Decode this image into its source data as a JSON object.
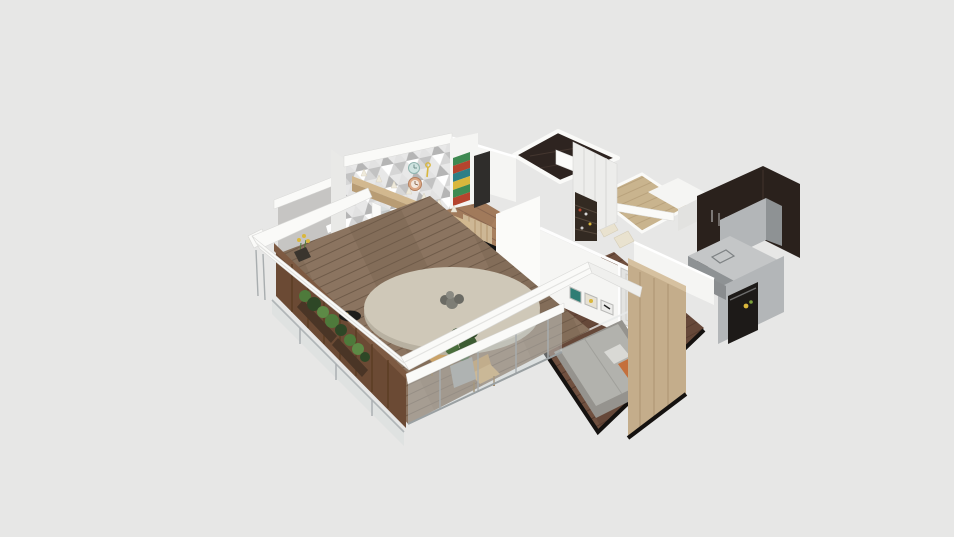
{
  "scene": {
    "type": "3d-floorplan-isometric-render",
    "description": "White-walled apartment model viewed from above at an angle on a plain light-gray backdrop; no UI chrome, text or controls visible",
    "background_color": "#e7e7e6",
    "rooms": [
      {
        "name": "balcony-terrace",
        "floor": "wood-deck",
        "features": [
          "wood-privacy-fence",
          "hedge-planters",
          "glass-railings",
          "round-dining-table",
          "dark-centerpiece",
          "two-wooden-chairs",
          "potted-plant",
          "yellow-flower-pot",
          "white-pergola-beams"
        ]
      },
      {
        "name": "living-room",
        "floor": "wood",
        "features": [
          "triangle-mosaic-accent-wall",
          "teal-wall-clock",
          "copper-wall-clock",
          "key-wall-decor",
          "striped-artwork",
          "bar-ledge-with-cone-lamps",
          "glass-partition",
          "white-staircase",
          "black-stools",
          "tv-screen",
          "gold-mosaic-panels",
          "wood-slat-panel",
          "gray-concrete-wall",
          "terrazzo-strip",
          "white-shelves"
        ]
      },
      {
        "name": "bedroom",
        "floor": "dark-wood",
        "features": [
          "gray-bed",
          "orange-pillow",
          "white-pillow",
          "oak-wardrobe-panel",
          "three-art-frames",
          "white-door",
          "glass-partition",
          "black-base-trim"
        ]
      },
      {
        "name": "walk-in-closet",
        "floor": "dark-gloss-tile",
        "features": [
          "white-wardrobe-fronts",
          "open-shoe-shelf",
          "white-cabinet"
        ]
      },
      {
        "name": "hallway-dining",
        "floor": "light-oak",
        "features": [
          "cream-chairs",
          "white-wall-beams"
        ]
      },
      {
        "name": "kitchen",
        "walls": "dark-brown",
        "features": [
          "gray-cabinets",
          "counter-with-sink",
          "black-oven-front",
          "hanging-utensils",
          "small-yellow-and-green-items"
        ]
      }
    ]
  },
  "palette": {
    "background": "#e7e7e6",
    "wall-white": "#f5f5f3",
    "wall-bright": "#fbfbf9",
    "wall-shadow": "#e2e2e0",
    "wall-gray": "#c6c5c3",
    "beam-white": "#fafaf8",
    "beam-edge": "#d9d9d7",
    "glass-tint": "#cdd6d8",
    "metal-gray": "#a8adaf",
    "deck-wood": "#8b7460",
    "deck-wood-line": "#6f5b49",
    "floor-wood": "#a8805f",
    "floor-wood-line": "#8a6750",
    "floor-oak": "#c9b48e",
    "floor-oak-line": "#b29a74",
    "floor-dark-wood": "#70503f",
    "floor-dark-line": "#573c2f",
    "dark-tile": "#2e2420",
    "fence-wood": "#6b4a34",
    "fence-wood-line": "#58391f",
    "fence-rail": "#7d5a42",
    "planter-box": "#4a3526",
    "plant-green": "#4e7a3b",
    "plant-green-dark": "#2e4726",
    "plant-green-light": "#5d8a46",
    "table-beige": "#cfc8b8",
    "table-rim": "#b8b1a1",
    "stairs-cream": "#efeadb",
    "stairs-cream-dark": "#ded7c5",
    "seat-black": "#262626",
    "bed-gray": "#95938e",
    "bed-light": "#b2b2ad",
    "pillow-orange": "#c4703c",
    "pillow-white": "#d9d9d5",
    "wardrobe-oak": "#c4ad8b",
    "wardrobe-oak-line": "#ab9372",
    "closet-white": "#ededeb",
    "shelf-dark": "#332a22",
    "kitchen-dark": "#2a211c",
    "cabinet-gray": "#b3b6b8",
    "cabinet-gray-dark": "#8e9294",
    "counter-top": "#c4c6c7",
    "oven-black": "#1d1a18",
    "gold": "#b5923c",
    "tv-black": "#141414",
    "wood-slat": "#cdb795",
    "bar-wood": "#d2b88f",
    "bar-wood-dark": "#b89c74",
    "clock-teal": "#cfe3e0",
    "clock-copper": "#dba886",
    "art-green": "#3f8a52",
    "art-red": "#b5442e",
    "art-teal": "#2e7f86",
    "art-cream": "#e6e1d3",
    "accent-yellow": "#d9b73c",
    "terrazzo": "#e7e4de",
    "door-gray": "#e3e3e1",
    "frame-teal": "#2f7d74",
    "trim-black": "#151210",
    "wood-chair": "#c9a268",
    "wood-chair-dark": "#8a6a3c",
    "pot-gray": "#9a9a96",
    "doorway-dark": "#2f2d2b"
  }
}
